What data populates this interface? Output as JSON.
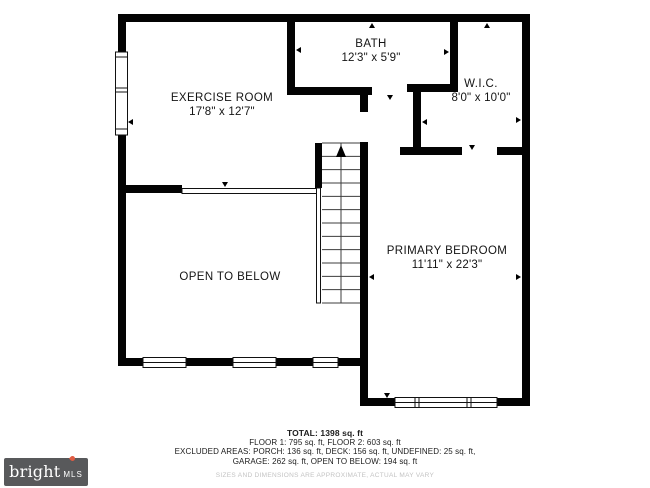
{
  "plan": {
    "rooms": [
      {
        "id": "bath",
        "name": "BATH",
        "dims": "12'3\" x 5'9\""
      },
      {
        "id": "exercise-room",
        "name": "EXERCISE ROOM",
        "dims": "17'8\" x 12'7\""
      },
      {
        "id": "wic",
        "name": "W.I.C.",
        "dims": "8'0\" x 10'0\""
      },
      {
        "id": "primary-bedroom",
        "name": "PRIMARY BEDROOM",
        "dims": "11'11\" x 22'3\""
      },
      {
        "id": "open-to-below",
        "name": "OPEN TO BELOW",
        "dims": ""
      }
    ],
    "stairs_direction": "up"
  },
  "footer": {
    "total": "TOTAL: 1398 sq. ft",
    "floors": "FLOOR 1: 795 sq. ft, FLOOR 2: 603 sq. ft",
    "excluded_line1": "EXCLUDED AREAS: PORCH: 136 sq. ft, DECK: 156 sq. ft, UNDEFINED: 25 sq. ft,",
    "excluded_line2": "GARAGE: 262 sq. ft, OPEN TO BELOW: 194 sq. ft",
    "disclaimer": "SIZES AND DIMENSIONS ARE APPROXIMATE, ACTUAL MAY VARY"
  },
  "logo": {
    "brand": "bright",
    "suffix": "MLS",
    "background_color": "#58595b",
    "accent_color": "#e05c43"
  }
}
